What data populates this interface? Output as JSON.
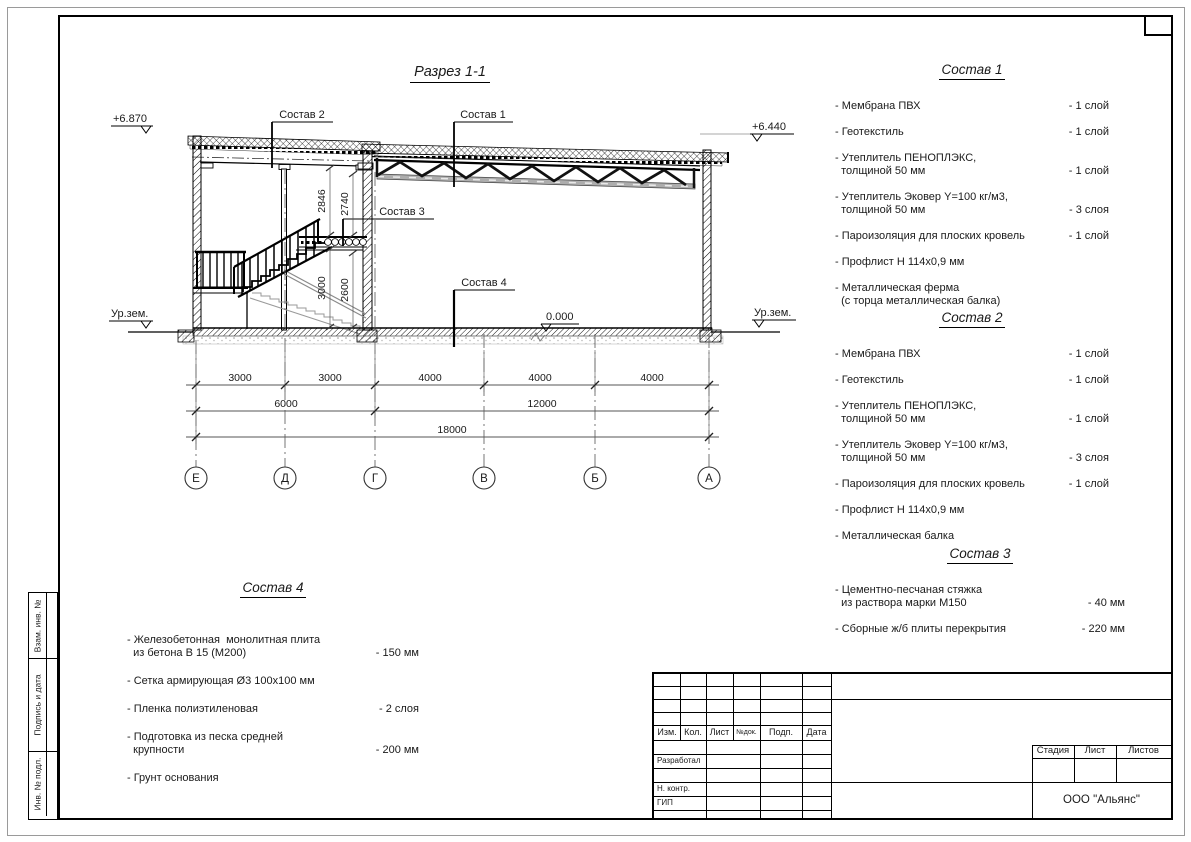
{
  "page": {
    "section_title": "Разрез 1-1"
  },
  "section": {
    "elev_top_left": "+6.870",
    "elev_top_right": "+6.440",
    "elev_zero": "0.000",
    "ground_left": "Ур.зем.",
    "ground_right": "Ур.зем.",
    "leader_roof_left": "Состав 2",
    "leader_roof_right": "Состав 1",
    "leader_slab": "Состав 3",
    "leader_floor": "Состав 4",
    "vdim1": "2846",
    "vdim2": "2740",
    "vdim3": "3000",
    "vdim4": "2600",
    "dims1": [
      "3000",
      "3000",
      "4000",
      "4000",
      "4000"
    ],
    "dims2": [
      "6000",
      "12000"
    ],
    "dims3": [
      "18000"
    ],
    "axes": [
      "Е",
      "Д",
      "Г",
      "В",
      "Б",
      "А"
    ]
  },
  "compositions": [
    {
      "title": "Состав 1",
      "items": [
        {
          "name": "- Мембрана ПВХ",
          "qty": "- 1 слой"
        },
        {
          "name": "- Геотекстиль",
          "qty": "- 1 слой"
        },
        {
          "name": "- Утеплитель ПЕНОПЛЭКС,\n  толщиной 50 мм",
          "qty": "- 1 слой"
        },
        {
          "name": "- Утеплитель Эковер Y=100 кг/м3,\n  толщиной 50 мм",
          "qty": "- 3 слоя"
        },
        {
          "name": "- Пароизоляция для плоских кровель",
          "qty": "- 1 слой"
        },
        {
          "name": "- Профлист Н 114х0,9 мм",
          "qty": ""
        },
        {
          "name": "- Металлическая ферма\n  (с торца металлическая балка)",
          "qty": ""
        }
      ]
    },
    {
      "title": "Состав 2",
      "items": [
        {
          "name": "- Мембрана ПВХ",
          "qty": "- 1 слой"
        },
        {
          "name": "- Геотекстиль",
          "qty": "- 1 слой"
        },
        {
          "name": "- Утеплитель ПЕНОПЛЭКС,\n  толщиной 50 мм",
          "qty": "- 1 слой"
        },
        {
          "name": "- Утеплитель Эковер Y=100 кг/м3,\n  толщиной 50 мм",
          "qty": "- 3 слоя"
        },
        {
          "name": "- Пароизоляция для плоских кровель",
          "qty": "- 1 слой"
        },
        {
          "name": "- Профлист Н 114х0,9 мм",
          "qty": ""
        },
        {
          "name": "- Металлическая балка",
          "qty": ""
        }
      ]
    },
    {
      "title": "Состав 3",
      "items": [
        {
          "name": "- Цементно-песчаная стяжка\n  из раствора марки М150",
          "qty": "- 40 мм"
        },
        {
          "name": "- Сборные ж/б плиты перекрытия",
          "qty": "- 220 мм"
        }
      ]
    },
    {
      "title": "Состав 4",
      "items": [
        {
          "name": "- Железобетонная  монолитная плита\n  из бетона В 15 (М200)",
          "qty": "- 150 мм"
        },
        {
          "name": "- Сетка армирующая Ø3 100х100 мм",
          "qty": ""
        },
        {
          "name": "- Пленка полиэтиленовая",
          "qty": "-  2 слоя"
        },
        {
          "name": "- Подготовка из песка средней\n  крупности",
          "qty": "- 200 мм"
        },
        {
          "name": "- Грунт основания",
          "qty": ""
        }
      ]
    }
  ],
  "titleblock": {
    "col_izm": "Изм.",
    "col_kol": "Кол.",
    "col_list": "Лист",
    "col_ndok": "№док.",
    "col_podp": "Подп.",
    "col_data": "Дата",
    "row_developed": "Разработал",
    "row_ncontr": "Н. контр.",
    "row_gip": "ГИП",
    "stage": "Стадия",
    "sheet": "Лист",
    "sheets": "Листов",
    "org": "ООО \"Альянс\""
  },
  "sidebar": {
    "labels": [
      "Взам. инв. №",
      "Подпись и дата",
      "Инв. № подл."
    ]
  }
}
